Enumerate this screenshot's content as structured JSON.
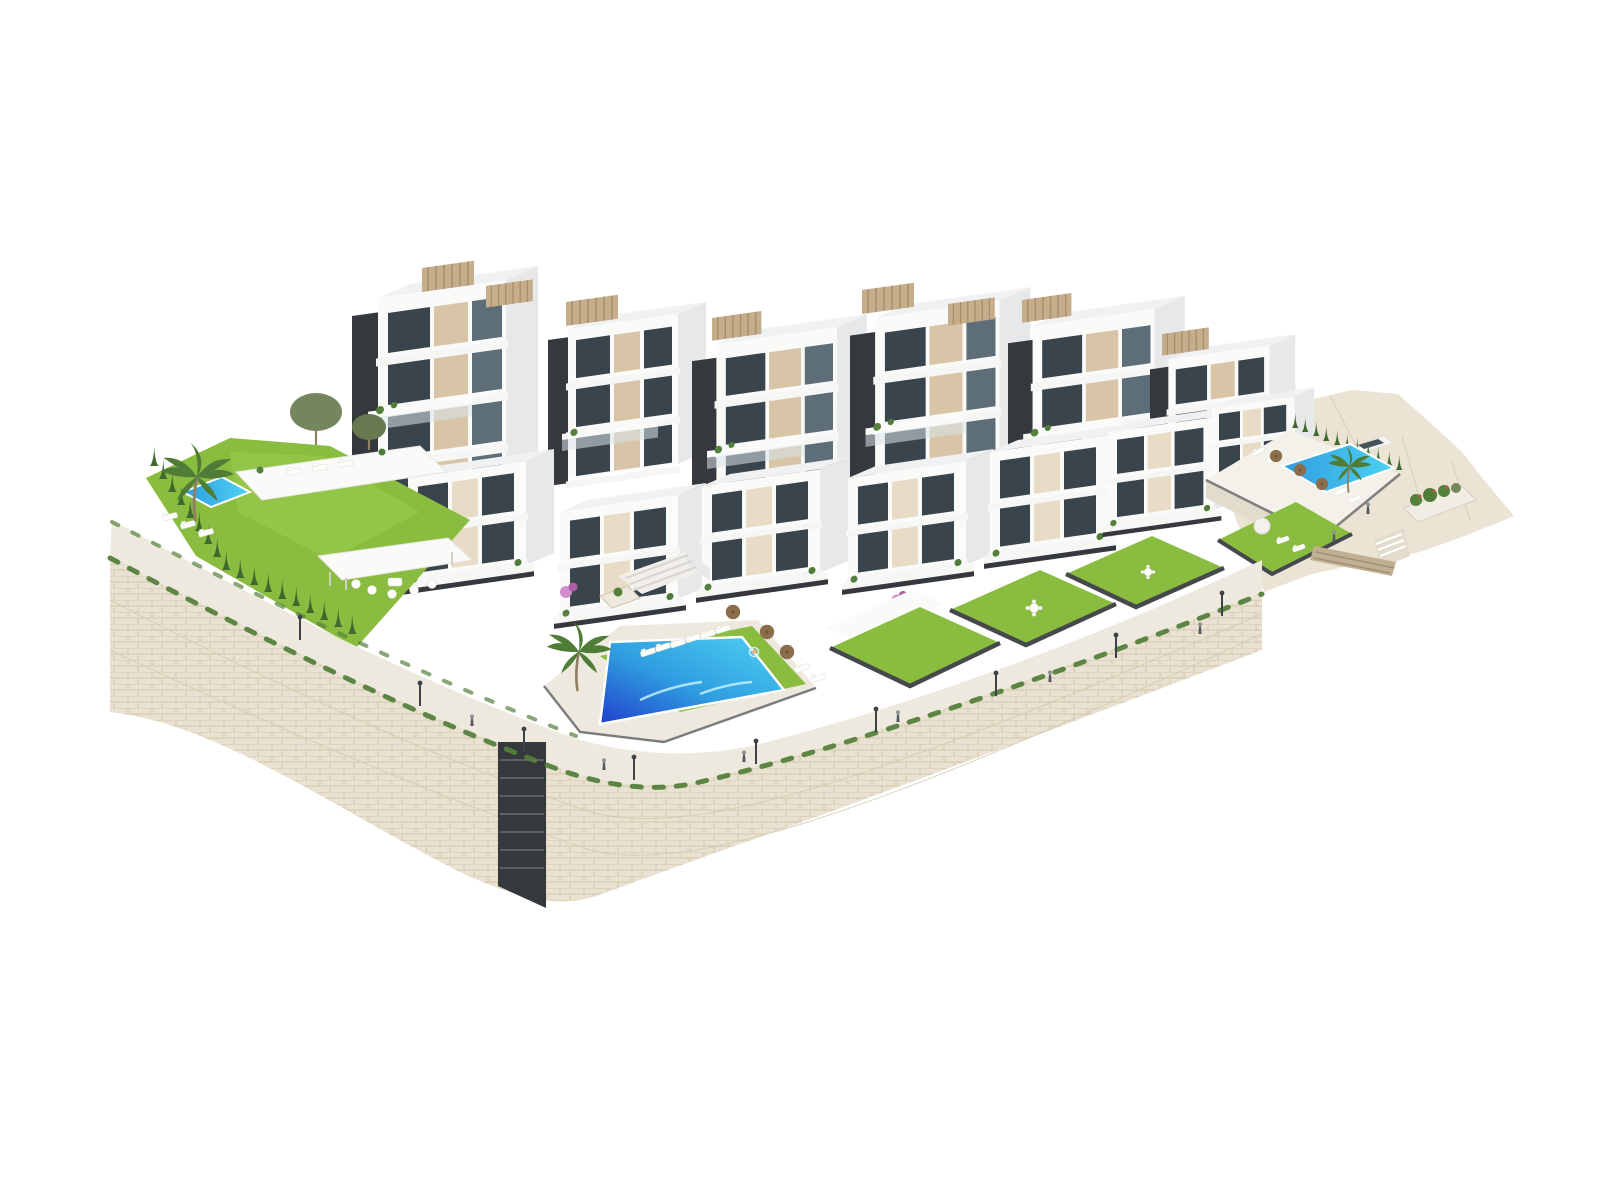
{
  "scene": {
    "type": "3d-architectural-exterior-render",
    "description": "Aerial 3D render of a white modern hillside residential complex with stepped apartment blocks, beige facade panels, glass balconies, rooftop pergolas, private lawned gardens, three swimming pools, a curved natural-stone retaining wall with a lamp-lined promenade, palm trees, cypress hedges and a small parking area with one white car, all on a plain white background.",
    "background": "#ffffff",
    "palette": {
      "background": "#ffffff",
      "building_white": "#fafaf9",
      "building_shade": "#e6e8ea",
      "roof_light": "#f0f1f2",
      "slab_white": "#f6f6f5",
      "glazing_dark": "#3a444c",
      "glazing_mid": "#5d6e78",
      "beige_panel": "#d8c5a7",
      "beige_light": "#e8dcc6",
      "anthracite": "#35393d",
      "pergola_tan": "#c6ae8c",
      "pergola_slat": "#a98f6b",
      "rail_glass": "#d8e3e9",
      "lawn_green": "#8abc3f",
      "lawn_light": "#9ccf52",
      "cypress_green": "#3f6a2e",
      "palm_green": "#4f7d38",
      "shrub_green": "#55803c",
      "olive_green": "#75855c",
      "olive_dark": "#687950",
      "flower_pink": "#cf8ec9",
      "flower_pink2": "#ad5fa6",
      "pool_deep": "#2140cc",
      "pool_mid": "#2f9de0",
      "pool_light": "#4ed2f2",
      "stone_base": "#e9e1d1",
      "stone_line": "#d2c6ac",
      "stone_dark": "#c0af92",
      "stone_dark_line": "#9c8a6c",
      "pavement": "#eee9de",
      "terrain_sand": "#ebe3d3",
      "terrain_facet": "#d8cdb8",
      "parapet_dark": "#46494c",
      "rattan_brown": "#8a6e4b",
      "rattan_dark": "#6a5336",
      "metal_dark": "#3e4246",
      "lounger_white": "#fdfdfb",
      "people_dark": "#54585c",
      "people_head": "#8d9296",
      "car_white": "#f4f4f2",
      "car_glass": "#46525c",
      "trunk_brown": "#8f7f63"
    },
    "counts": {
      "apartment_clusters": 6,
      "terraced_houses": 7,
      "rooftop_pergolas": 8,
      "swimming_pools": 3,
      "private_lawns": 6,
      "palm_trees": 3,
      "street_lamps": 9,
      "pedestrians": 8,
      "sun_loungers": 20,
      "parasols": 7,
      "parked_cars": 1
    },
    "features": [
      "stepped white apartment blocks with glass balconies",
      "beige facade panels and anthracite cores",
      "rooftop pergolas with timber slats",
      "large central pool with sun loungers and wicker parasols",
      "left private garden with plunge pool and cypress hedge",
      "right terrace pool with parking area and white car",
      "curved natural stone retaining wall with planted edge",
      "promenade with street lamps and pedestrians",
      "sandy rocky terrain on the right"
    ]
  }
}
